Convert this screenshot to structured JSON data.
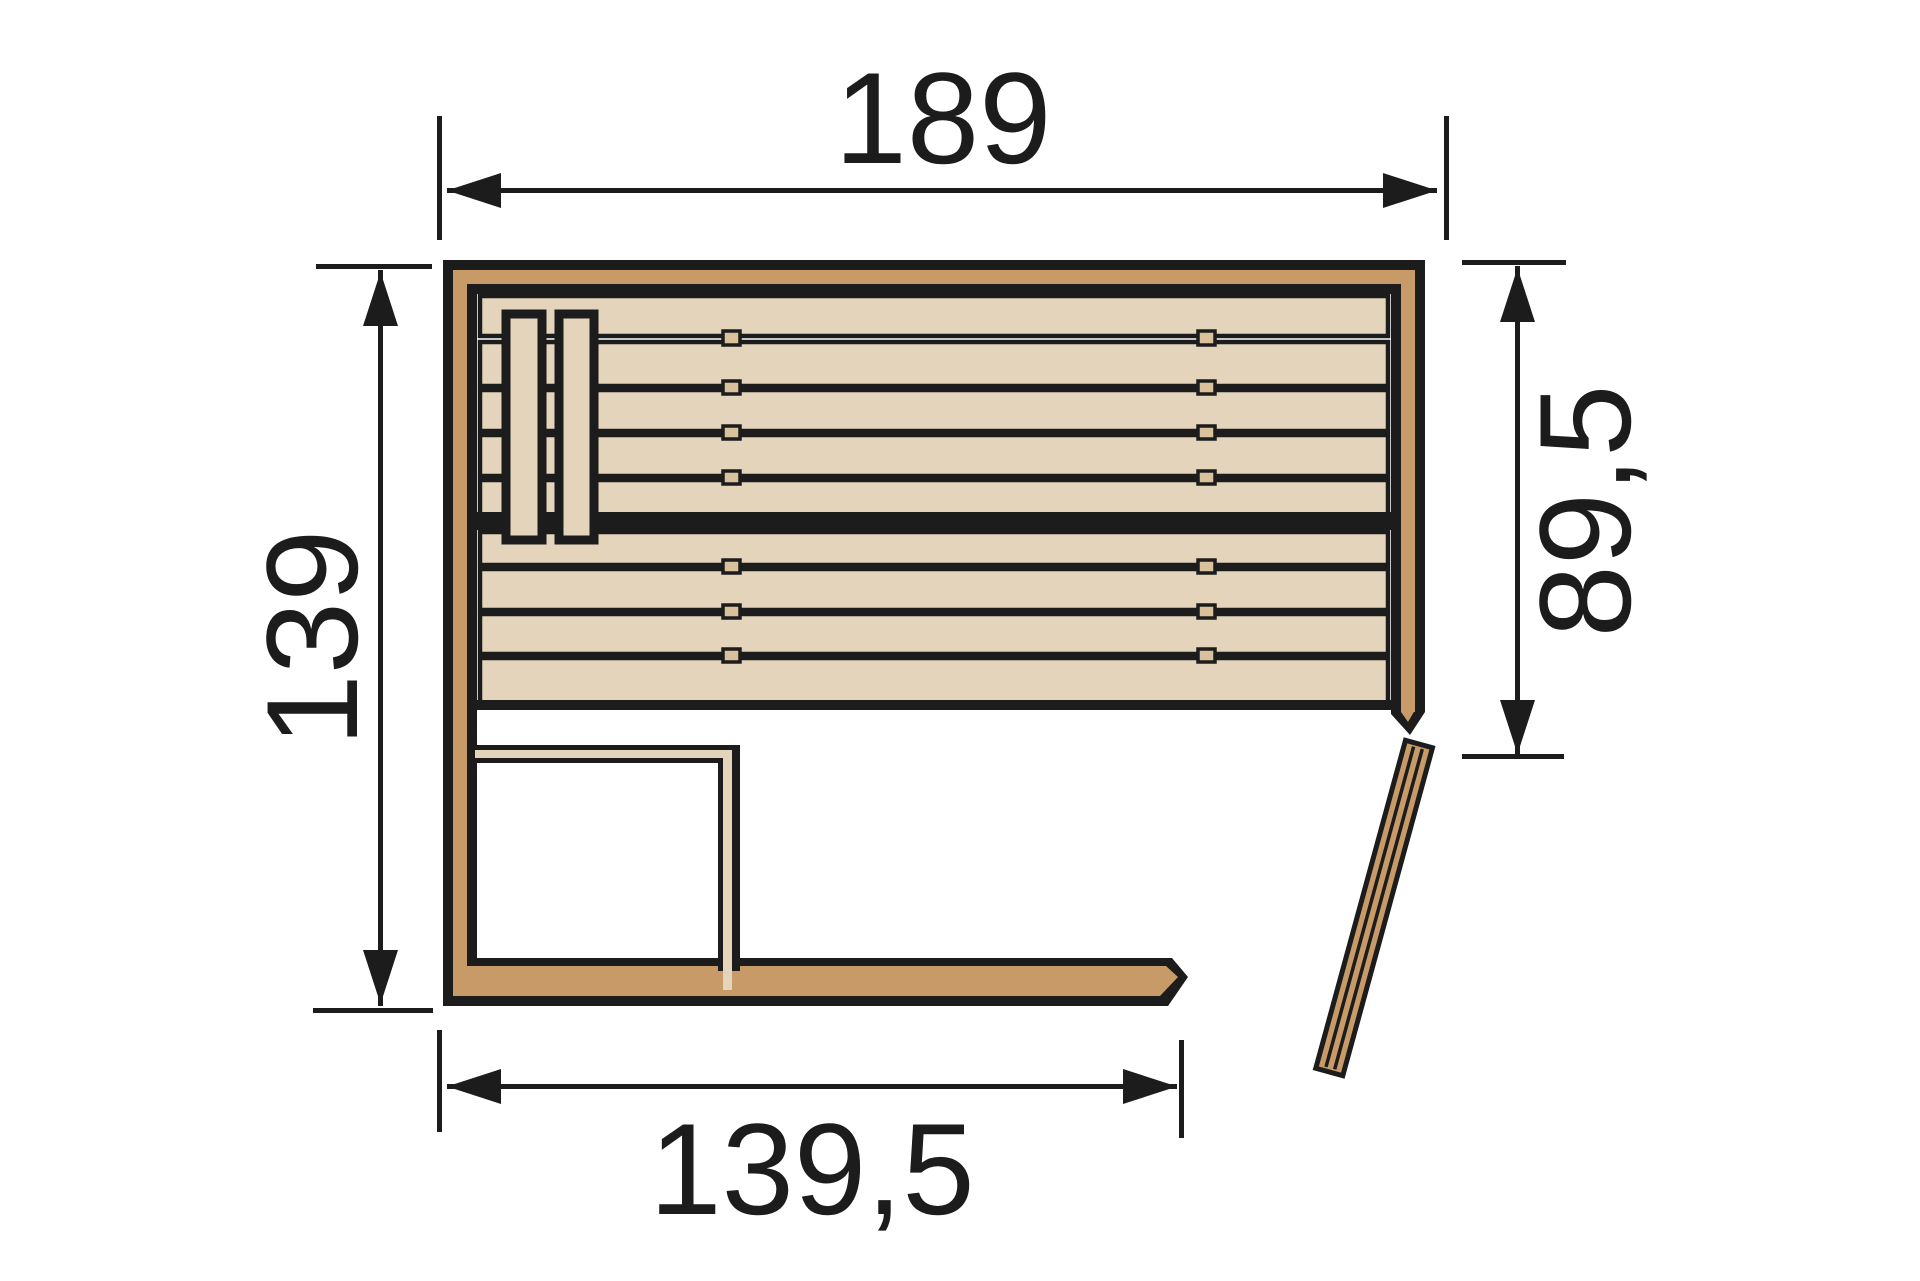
{
  "diagram": {
    "dimensions": {
      "top": "189",
      "left": "139",
      "right": "89,5",
      "bottom": "139,5"
    }
  },
  "colors": {
    "outline": "#1c1c1c",
    "wood-frame": "#c89a67",
    "wood-light": "#e4d4bc",
    "wood-tab": "#d9c29b",
    "background": "#ffffff"
  }
}
